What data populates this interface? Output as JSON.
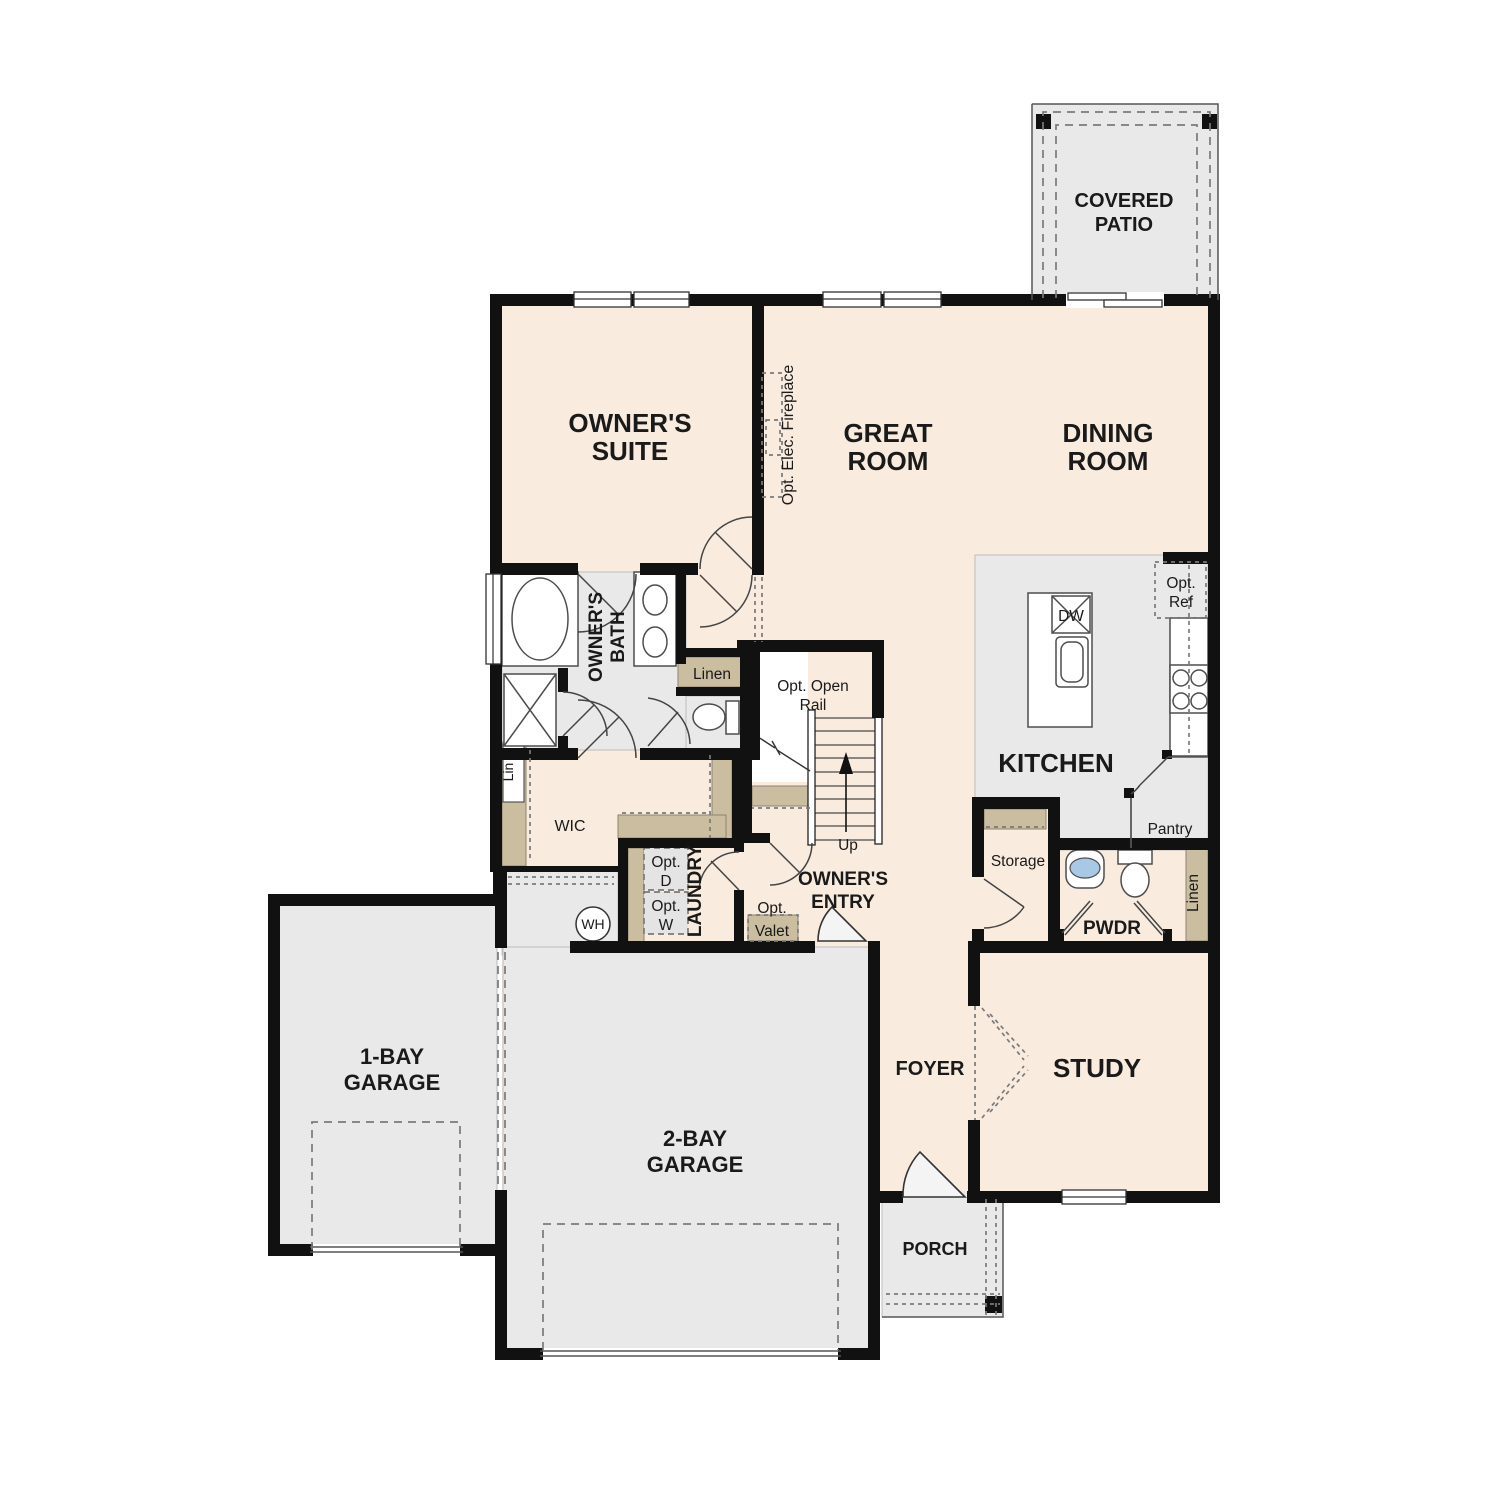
{
  "plan": {
    "rooms": {
      "covered_patio": {
        "line1": "COVERED",
        "line2": "PATIO"
      },
      "owners_suite": {
        "line1": "OWNER'S",
        "line2": "SUITE"
      },
      "great_room": {
        "line1": "GREAT",
        "line2": "ROOM"
      },
      "dining_room": {
        "line1": "DINING",
        "line2": "ROOM"
      },
      "owners_bath": {
        "line1": "OWNER'S",
        "line2": "BATH"
      },
      "wic": {
        "label": "WIC"
      },
      "kitchen": {
        "label": "KITCHEN"
      },
      "laundry": {
        "label": "LAUNDRY"
      },
      "owners_entry": {
        "line1": "OWNER'S",
        "line2": "ENTRY"
      },
      "pwdr": {
        "label": "PWDR"
      },
      "storage": {
        "label": "Storage"
      },
      "pantry": {
        "label": "Pantry"
      },
      "foyer": {
        "label": "FOYER"
      },
      "study": {
        "label": "STUDY"
      },
      "porch": {
        "label": "PORCH"
      },
      "garage_1bay": {
        "line1": "1-BAY",
        "line2": "GARAGE"
      },
      "garage_2bay": {
        "line1": "2-BAY",
        "line2": "GARAGE"
      }
    },
    "annotations": {
      "opt_elec_fireplace": "Opt. Elec. Fireplace",
      "opt_open_rail": {
        "line1": "Opt. Open",
        "line2": "Rail"
      },
      "up": "Up",
      "linen_bath": "Linen",
      "lin_wic": "Lin",
      "linen_pwdr": "Linen",
      "opt_dryer": {
        "line1": "Opt.",
        "line2": "D"
      },
      "opt_washer": {
        "line1": "Opt.",
        "line2": "W"
      },
      "opt_valet": {
        "line1": "Opt.",
        "line2": "Valet"
      },
      "water_heater": "WH",
      "dishwasher": "DW",
      "opt_ref": {
        "line1": "Opt.",
        "line2": "Ref"
      }
    },
    "colors": {
      "wall": "#111111",
      "living_floor": "#f9ecdf",
      "hard_floor": "#e9e9e9",
      "closet_shelf": "#cbbd9f",
      "sink_water": "#a9c8e6",
      "dashed_line": "#7a7a7a"
    }
  }
}
